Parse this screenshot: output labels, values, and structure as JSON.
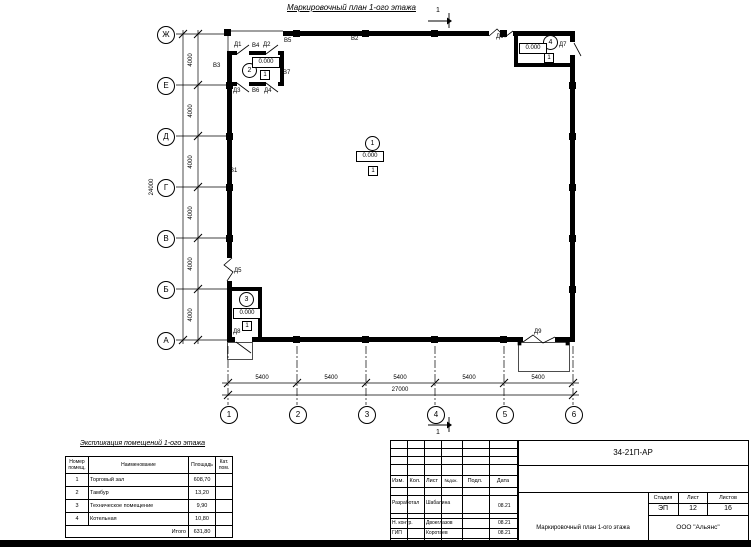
{
  "plan_title": "Маркировочный план 1-ого этажа",
  "section_number": "1",
  "axes": {
    "rows": [
      "Ж",
      "Е",
      "Д",
      "Г",
      "В",
      "Б",
      "А"
    ],
    "cols": [
      "1",
      "2",
      "3",
      "4",
      "5",
      "6"
    ]
  },
  "dims": {
    "row_step": "4000",
    "row_total": "24000",
    "col_step": "5400",
    "col_total": "27000"
  },
  "rooms": [
    {
      "number": "1",
      "elevation": "0.000",
      "floor_type": "1"
    },
    {
      "number": "2",
      "elevation": "0.000",
      "floor_type": "1"
    },
    {
      "number": "3",
      "elevation": "0.000",
      "floor_type": "1"
    },
    {
      "number": "4",
      "elevation": "0.000",
      "floor_type": "1"
    }
  ],
  "marks": {
    "v1": "В1",
    "v2": "В2",
    "v3": "В3",
    "v4": "В4",
    "v5": "В5",
    "v6": "В6",
    "v7": "В7",
    "d1": "Д1",
    "d2": "Д2",
    "d3": "Д3",
    "d4": "Д4",
    "d5": "Д5",
    "d6": "Д6",
    "d7": "Д7",
    "d8": "Д8",
    "d9": "Д9"
  },
  "explication": {
    "title": "Экспликация помещений 1-ого этажа",
    "headers": {
      "number": "Номер помещ.",
      "name": "Наименование",
      "area": "Площадь",
      "category": "Кат. пом."
    },
    "rows": [
      {
        "number": "1",
        "name": "Торговый зал",
        "area": "608,70"
      },
      {
        "number": "2",
        "name": "Тамбур",
        "area": "13,20"
      },
      {
        "number": "3",
        "name": "Техническое помещение",
        "area": "9,90"
      },
      {
        "number": "4",
        "name": "Котельная",
        "area": "10,80"
      }
    ],
    "total_label": "Итого",
    "total_area": "631,80"
  },
  "title_block": {
    "doc_number": "34-21П-АР",
    "columns": {
      "izm": "Изм.",
      "kol": "Кол.",
      "list": "Лист",
      "ndoc": "№док.",
      "podl": "Подл.",
      "data": "Дата"
    },
    "roles": [
      {
        "role": "Разработал",
        "name": "Шабалина",
        "date": "08.21"
      },
      {
        "role": "Н. контр.",
        "name": "Двоеглазов",
        "date": "08.21"
      },
      {
        "role": "ГИП",
        "name": "Коротаев",
        "date": "08.21"
      }
    ],
    "drawing_title": "Маркировочный план 1-ого этажа",
    "stage_label": "Стадия",
    "sheet_label": "Лист",
    "sheets_label": "Листов",
    "stage": "ЭП",
    "sheet": "12",
    "sheets": "16",
    "company": "ООО \"Альянс\""
  }
}
